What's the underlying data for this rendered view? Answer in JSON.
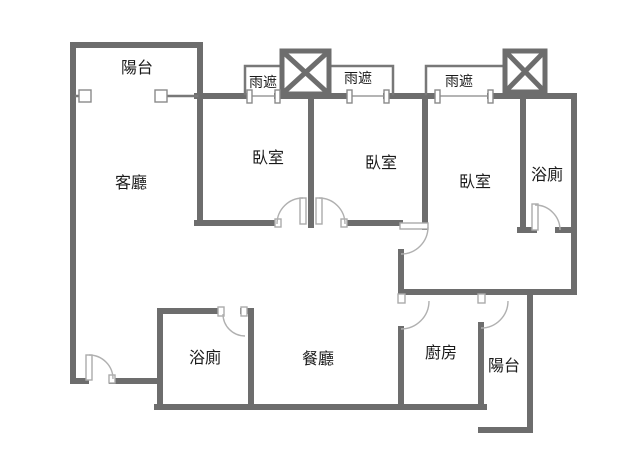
{
  "meta": {
    "type": "apartment-floor-plan",
    "background_color": "#ffffff",
    "wall_color": "#6d6d6d",
    "door_color": "#b0b0b0",
    "text_color": "#1a1a1a"
  },
  "labels": {
    "balcony_top": "陽台",
    "rain_shade_left": "雨遮",
    "rain_shade_mid": "雨遮",
    "rain_shade_right": "雨遮",
    "living_room": "客廳",
    "bedroom_1": "臥室",
    "bedroom_2": "臥室",
    "bedroom_3": "臥室",
    "bathroom_top": "浴廁",
    "bathroom_bottom": "浴廁",
    "dining_room": "餐廳",
    "kitchen": "廚房",
    "balcony_bottom": "陽台"
  }
}
